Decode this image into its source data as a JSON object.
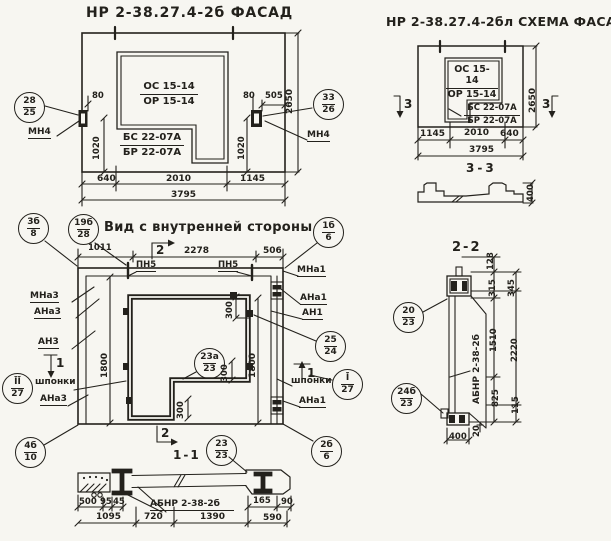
{
  "colors": {
    "paper": "#f7f6f1",
    "ink": "#23211c"
  },
  "facade": {
    "title": "НР 2-38.27.4-2б  ФАСАД",
    "opening_top": "ОС 15-14",
    "opening_bottom": "ОР 15-14",
    "sill_top": "БС 22-07А",
    "sill_bottom": "БР 22-07А",
    "anchor_left_label": "МН4",
    "anchor_right_label": "МН4",
    "callout_left": {
      "top": "28",
      "bottom": "25"
    },
    "callout_right": {
      "top": "33",
      "bottom": "26"
    },
    "dims": {
      "w80l": "80",
      "w80r": "80",
      "w505": "505",
      "h1020l": "1020",
      "h1020r": "1020",
      "b640": "640",
      "b2010": "2010",
      "b1145": "1145",
      "b3795": "3795",
      "h2650": "2650"
    }
  },
  "schema": {
    "title": "НР 2-38.27.4-2бл СХЕМА ФАСАДА",
    "opening_top": "ОС 15-14",
    "opening_bottom": "ОР 15-14",
    "sill_top": "БС 22-07А",
    "sill_bottom": "БР 22-07А",
    "marker_left": "3",
    "marker_right": "3",
    "dims": {
      "b1145": "1145",
      "b2010": "2010",
      "b640": "640",
      "b3795": "3795",
      "h2650": "2650"
    },
    "section": {
      "title": "3-3",
      "d400": "400"
    }
  },
  "inner": {
    "title": "Вид с внутренней стороны",
    "labels": {
      "pn5a": "ПН5",
      "pn5b": "ПН5",
      "mna3": "МНа3",
      "ana3": "АНа3",
      "an3": "АН3",
      "ana3b": "АНа3",
      "mna1": "МНа1",
      "ana1": "АНа1",
      "an1": "АН1",
      "ana1b": "АНа1",
      "shponki_left": "шпонки",
      "shponki_right": "шпонки"
    },
    "markers": {
      "m2top": "2",
      "m1left": "1",
      "m1right": "1",
      "m2bottom": "2"
    },
    "callouts": {
      "c3b8": {
        "top": "3б",
        "bottom": "8"
      },
      "c19b28": {
        "top": "19б",
        "bottom": "28"
      },
      "c1b6": {
        "top": "1б",
        "bottom": "6"
      },
      "c2524": {
        "top": "25",
        "bottom": "24"
      },
      "cI27": {
        "top": "Ī",
        "bottom": "27"
      },
      "cII27": {
        "top": "ĪĪ",
        "bottom": "27"
      },
      "c2b6": {
        "top": "2б",
        "bottom": "6"
      },
      "c4b10": {
        "top": "4б",
        "bottom": "10"
      },
      "c23a23": {
        "top": "23а",
        "bottom": "23"
      },
      "c2323": {
        "top": "23",
        "bottom": "23"
      }
    },
    "dims": {
      "t1011": "1011",
      "t2278": "2278",
      "t506": "506",
      "h1800l": "1800",
      "h1800r": "1800",
      "d300a": "300",
      "d300b": "300",
      "d300c": "300"
    }
  },
  "sec11": {
    "title": "1-1",
    "label": "АБНР 2-38-2б",
    "dims": {
      "d500": "500",
      "d95": "95",
      "d45": "45",
      "d165": "165",
      "d90": "90",
      "d1095": "1095",
      "d720": "720",
      "d1390": "1390",
      "d590": "590"
    }
  },
  "sec22": {
    "title": "2-2",
    "label": "АБНР 2-38-2б",
    "callouts": {
      "c2023": {
        "top": "20",
        "bottom": "23"
      },
      "c24b23": {
        "top": "24б",
        "bottom": "23"
      }
    },
    "dims": {
      "d128": "128",
      "d315": "315",
      "d345": "345",
      "d1510": "1510",
      "d2220": "2220",
      "d825": "825",
      "d115": "115",
      "d20": "20",
      "d400": "400"
    }
  }
}
